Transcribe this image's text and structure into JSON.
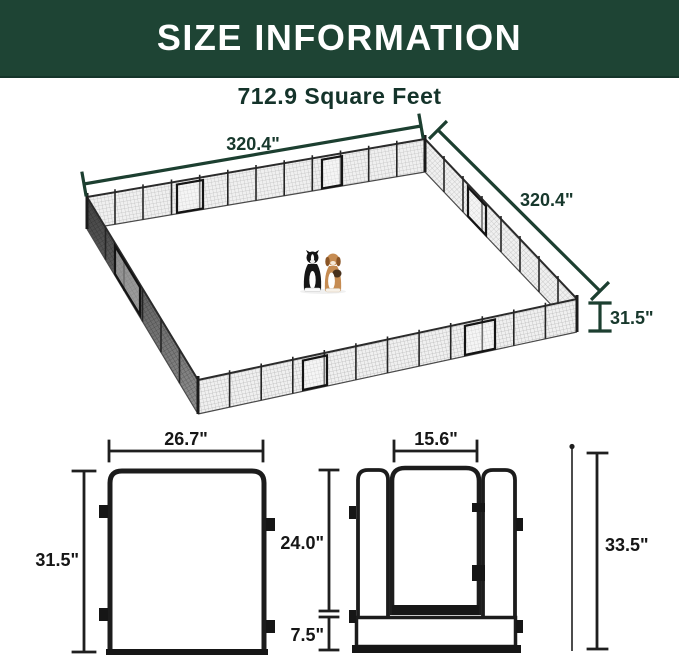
{
  "header": {
    "title": "SIZE INFORMATION"
  },
  "subtitle": "712.9 Square Feet",
  "colors": {
    "header_bg": "#1e4434",
    "header_text": "#ffffff",
    "dimension_green": "#1c3f30",
    "dimension_black": "#1f1f1f",
    "subtitle_text": "#14332a",
    "fence_frame": "#1c1c1c",
    "mesh_light": "#f0f0f0",
    "mesh_dark": "#8a8a8a"
  },
  "pen_diagram": {
    "top_width": "320.4\"",
    "side_width": "320.4\"",
    "wall_height": "31.5\"",
    "dogs": [
      "border-collie",
      "beagle"
    ]
  },
  "panel_diagram": {
    "panel_width": "26.7\"",
    "panel_height": "31.5\""
  },
  "door_panel_diagram": {
    "door_width": "15.6\"",
    "door_height": "24.0\"",
    "bottom_rail_height": "7.5\"",
    "stake_total_height": "33.5\""
  }
}
